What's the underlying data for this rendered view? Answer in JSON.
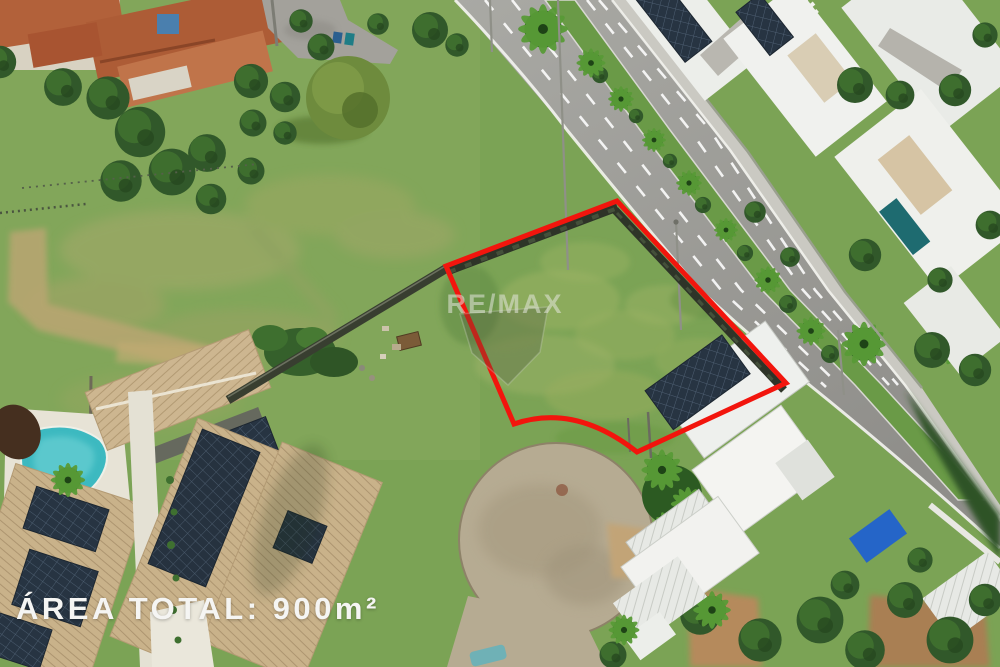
{
  "overlay": {
    "area_label": "ÁREA TOTAL: 900m²"
  },
  "watermark": {
    "text": "RE/MAX"
  },
  "plot_outline": {
    "color": "#f2150d"
  }
}
